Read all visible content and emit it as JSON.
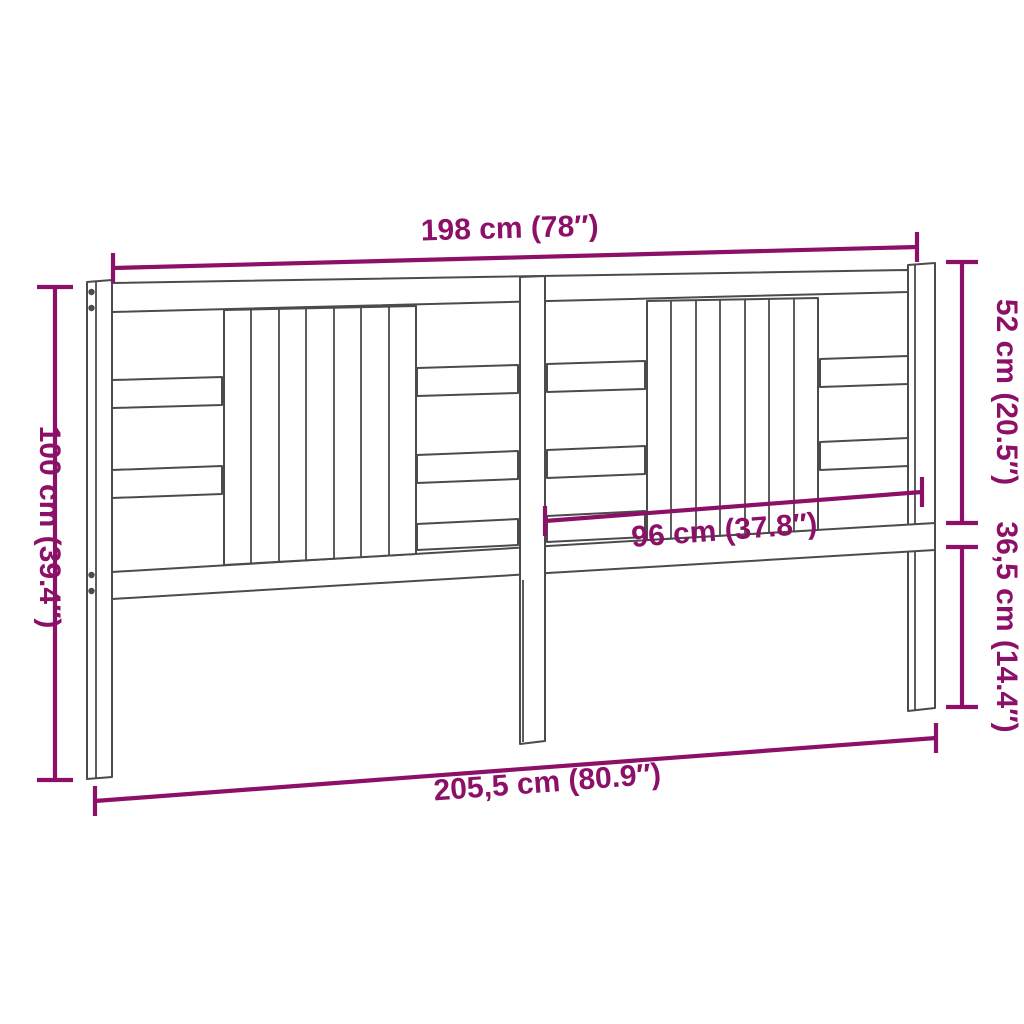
{
  "diagram": {
    "type": "product-dimension-diagram",
    "product": "slatted wooden headboard",
    "labels": {
      "width_top": "198 cm (78″)",
      "height_left": "100 cm (39.4″)",
      "height_upper_right": "52 cm (20.5″)",
      "width_half": "96 cm (37.8″)",
      "height_lower_right": "36,5 cm (14.4″)",
      "width_total": "205,5 cm (80.9″)"
    },
    "colors": {
      "dimension": "#8d1068",
      "outline": "#4b4b4b",
      "background": "#ffffff"
    }
  }
}
